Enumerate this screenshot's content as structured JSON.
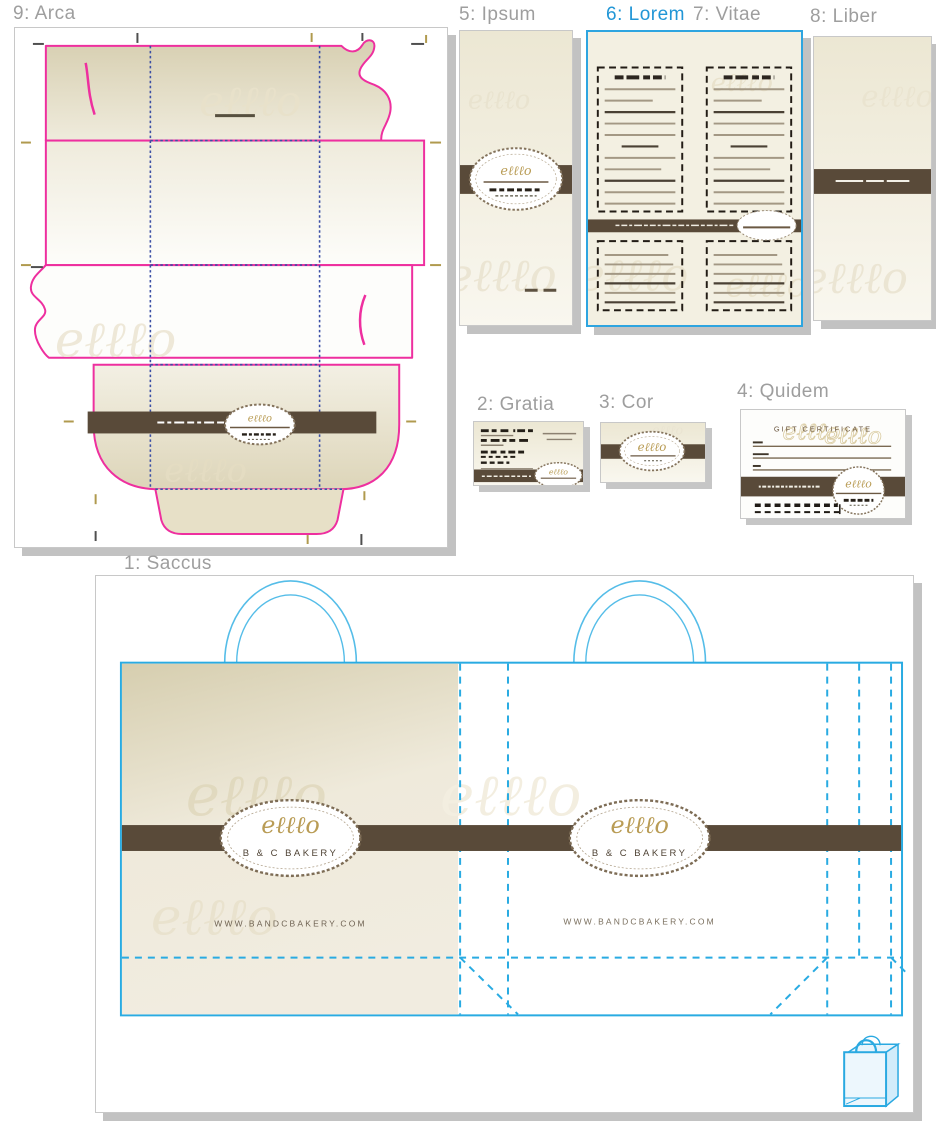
{
  "artboards": {
    "saccus": {
      "label": "1: Saccus"
    },
    "gratia": {
      "label": "2: Gratia"
    },
    "cor": {
      "label": "3: Cor"
    },
    "quidem": {
      "label": "4: Quidem"
    },
    "ipsum": {
      "label": "5: Ipsum"
    },
    "lorem": {
      "label": "6: Lorem"
    },
    "vitae": {
      "label": "7: Vitae"
    },
    "liber": {
      "label": "8: Liber"
    },
    "arca": {
      "label": "9: Arca"
    }
  },
  "brand": {
    "logo_mark": "eℓℓℓo",
    "name": "B & C BAKERY",
    "website": "WWW.BANDCBAKERY.COM",
    "gift_certificate_title": "GIFT CERTIFICATE"
  },
  "colors": {
    "accent_cyan": "#29abe2",
    "selection_blue": "#2ea5e0",
    "active_label_blue": "#2196d6",
    "label_gray": "#9e9e9e",
    "cut_magenta": "#ee2f9f",
    "fold_blue": "#3b4fa5",
    "band_brown": "#594a39",
    "logo_gold": "#b99c55",
    "shadow_gray": "#c2c2c2"
  }
}
